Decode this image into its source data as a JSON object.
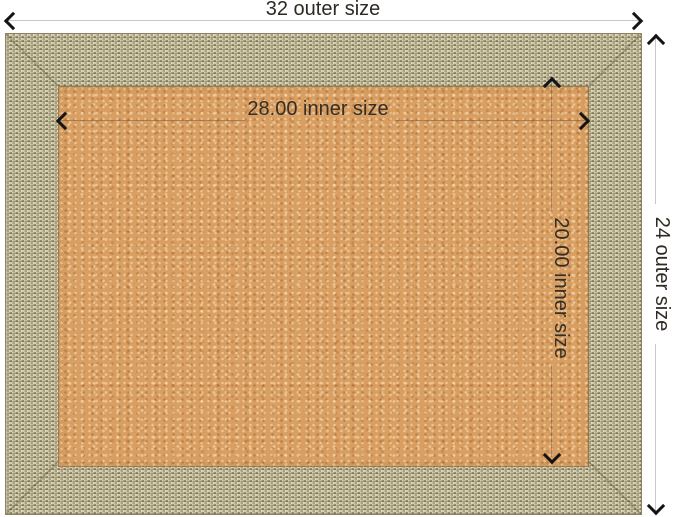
{
  "annotations": {
    "outer_width": "32 outer size",
    "outer_height": "24 outer size",
    "inner_width": "28.00 inner size",
    "inner_height": "20.00 inner size"
  },
  "colors": {
    "background": "#ffffff",
    "text": "#2e2922",
    "dim_line": "#c8c8c8",
    "inner_dim_line": "rgba(96,78,58,0.40)",
    "arrow": "#141414",
    "frame_base": "#b1a886",
    "frame_light": "#d3cca9",
    "frame_dark": "#958c6b",
    "cork_base": "#d89e62"
  }
}
